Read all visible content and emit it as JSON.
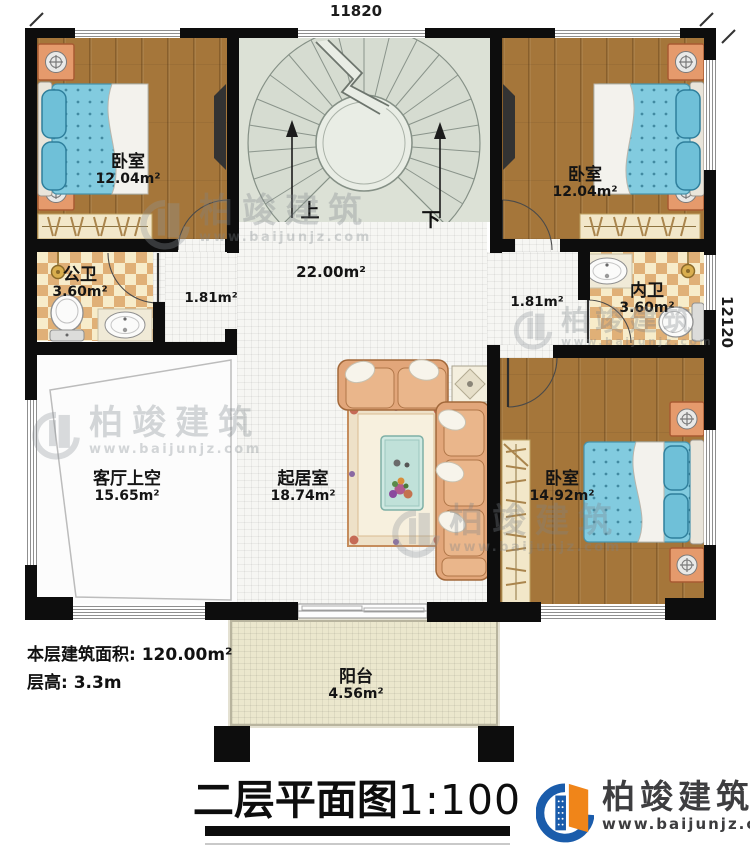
{
  "dimensions": {
    "top": "11820",
    "right": "12120"
  },
  "stairs": {
    "up_label": "上",
    "down_label": "下"
  },
  "rooms": {
    "bedroom_tl": {
      "name": "卧室",
      "area": "12.04m²"
    },
    "bedroom_tr": {
      "name": "卧室",
      "area": "12.04m²"
    },
    "bedroom_br": {
      "name": "卧室",
      "area": "14.92m²"
    },
    "public_bath": {
      "name": "公卫",
      "area": "3.60m²"
    },
    "private_bath": {
      "name": "内卫",
      "area": "3.60m²"
    },
    "living_void": {
      "name": "客厅上空",
      "area": "15.65m²"
    },
    "living_room": {
      "name": "起居室",
      "area": "18.74m²"
    },
    "balcony": {
      "name": "阳台",
      "area": "4.56m²"
    },
    "hall": {
      "area": "22.00m²"
    },
    "corridor_left": {
      "area": "1.81m²"
    },
    "corridor_right": {
      "area": "1.81m²"
    }
  },
  "notes": {
    "floor_area": "本层建筑面积: 120.00m²",
    "floor_height": "层高: 3.3m"
  },
  "title": {
    "text": "二层平面图",
    "scale": "1:100"
  },
  "branding": {
    "name": "柏竣建筑",
    "website": "www.baijunjz.com"
  },
  "watermark": {
    "name": "柏竣建筑",
    "website": "www.baijunjz.com"
  },
  "colors": {
    "wall": "#0d0d0d",
    "wood": "#a5763a",
    "tile": "#f6f6f3",
    "checker_dark": "#e0b077",
    "checker_light": "#f7ecca",
    "stair": "#dce1d6",
    "balcony": "#ebe7cd",
    "brand_blue": "#1a5cab",
    "brand_orange": "#f08519"
  }
}
